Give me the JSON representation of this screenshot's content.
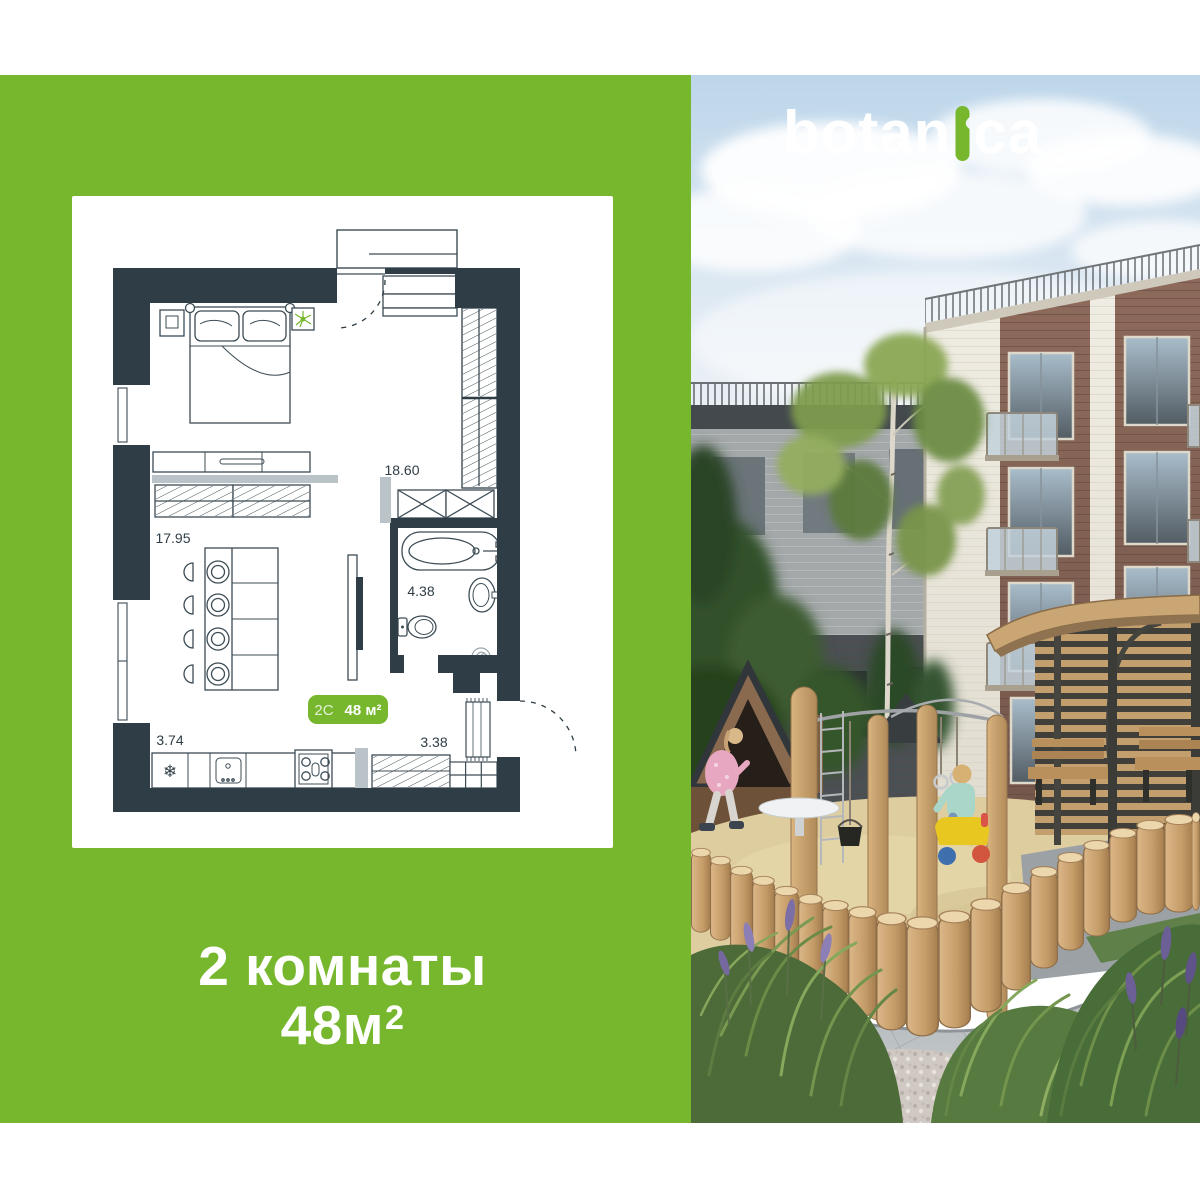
{
  "brand": {
    "logo_pre": "botan",
    "logo_post": "ca",
    "subtitle": "квартал-парк",
    "accent": "#76B72D"
  },
  "floorplan": {
    "wall_color": "#2E3D46",
    "badge": {
      "code": "2С",
      "area": "48 м²"
    },
    "rooms": {
      "hall": "18.60",
      "living": "17.95",
      "bathroom": "4.38",
      "kitchen": "3.74",
      "entry": "3.38"
    },
    "icons": {
      "fridge_snowflake": "❄"
    }
  },
  "headline": {
    "line1": "2 комнаты",
    "area_base": "48м",
    "area_sup": "2"
  }
}
